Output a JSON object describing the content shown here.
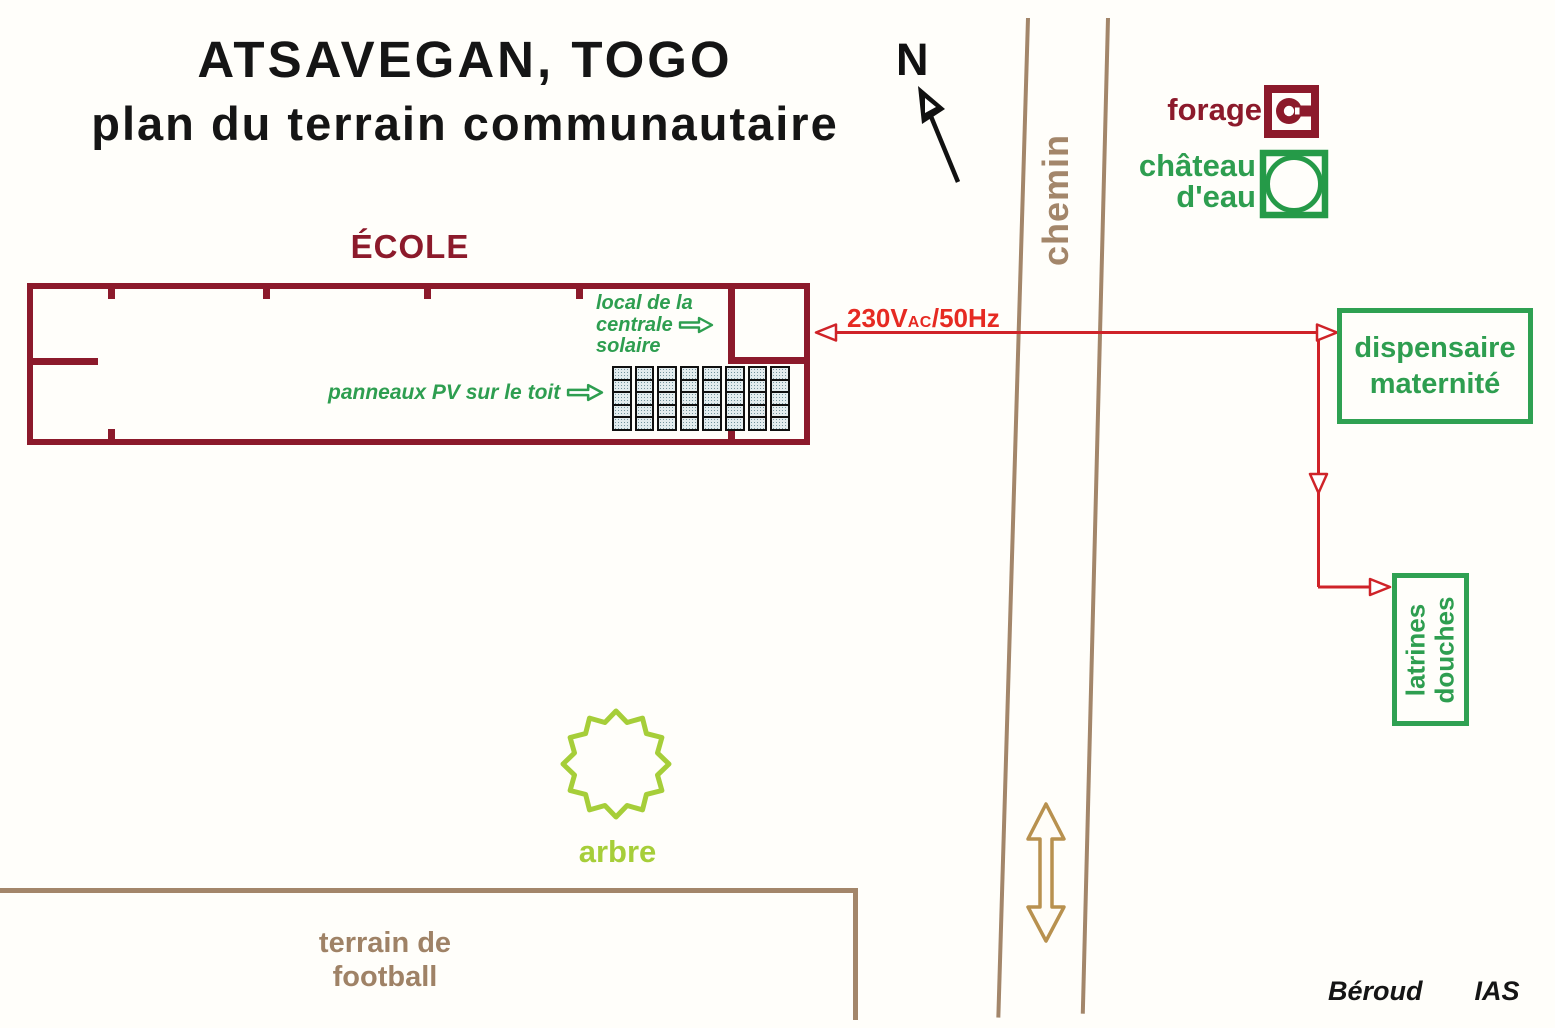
{
  "title": {
    "line1": "ATSAVEGAN, TOGO",
    "line2": "plan du terrain communautaire"
  },
  "compass": {
    "label": "N"
  },
  "road": {
    "label": "chemin"
  },
  "water": {
    "forage_label": "forage",
    "chateau_line1": "château",
    "chateau_line2": "d'eau"
  },
  "school": {
    "label": "ÉCOLE",
    "solar_room": {
      "line1": "local de la",
      "line2": "centrale",
      "line3": "solaire"
    },
    "pv_label": "panneaux PV sur le toit",
    "pv_grid": {
      "columns": 8,
      "rows": 5
    }
  },
  "power": {
    "volts": "230V",
    "ac": "AC",
    "freq": "/50Hz"
  },
  "buildings": {
    "dispensaire_line1": "dispensaire",
    "dispensaire_line2": "maternité",
    "latrines_line1": "latrines",
    "latrines_line2": "douches"
  },
  "tree": {
    "label": "arbre"
  },
  "football": {
    "line1": "terrain de",
    "line2": "football"
  },
  "credits": {
    "author": "Béroud",
    "org": "IAS"
  },
  "colors": {
    "maroon": "#8c1a2b",
    "green": "#2e9e50",
    "green_border": "#2fa152",
    "light_green": "#a6ce39",
    "brown": "#a3866a",
    "brown_text": "#9f8266",
    "red_line": "#cf2328",
    "red_label": "#e62a22",
    "tan": "#b8914f",
    "black": "#151515"
  }
}
